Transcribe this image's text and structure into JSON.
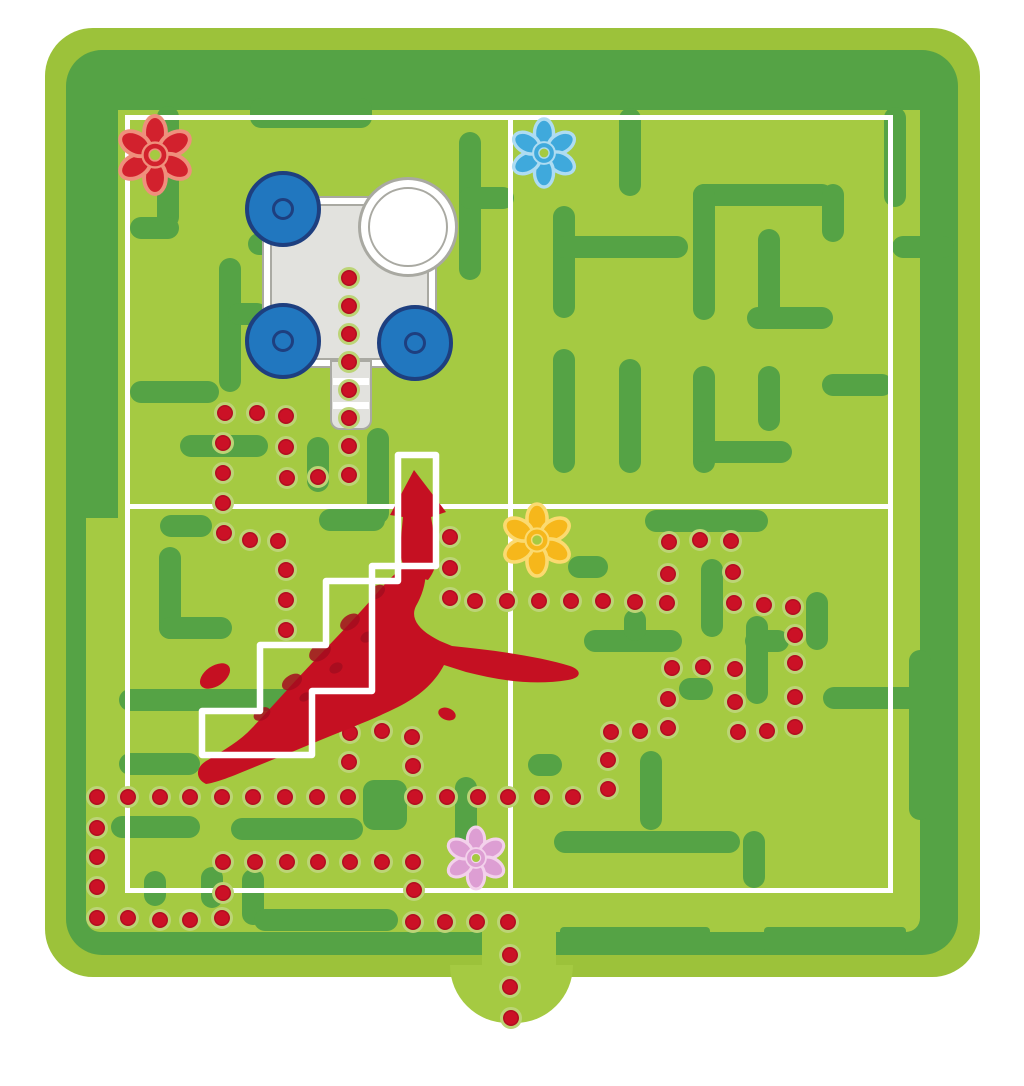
{
  "title": "garden-maze-game-board",
  "colors": {
    "page": "#ffffff",
    "rim_green": "#9cc23a",
    "band_green": "#55a345",
    "play_green": "#a5ca42",
    "wall_green": "#55a345",
    "dot_red": "#cb1126",
    "dot_outline": "#bcd476",
    "line_white": "#ffffff",
    "cart_gray": "#e2e2de",
    "cart_line_gray": "#a9a9a2",
    "wheel_blue": "#2177bf",
    "wheel_rim_blue": "#1e3f7f",
    "dragon_red": "#c51022",
    "dragon_dark_red": "#a30d1e"
  },
  "board": {
    "base": {
      "x": 45,
      "y": 28,
      "w": 935,
      "h": 949
    },
    "band": {
      "x": 66,
      "y": 50,
      "w": 892,
      "h": 905
    },
    "play": {
      "x": 86,
      "y": 90,
      "w": 834,
      "h": 842
    },
    "exit_gap": {
      "x": 482,
      "y": 918,
      "w": 74,
      "h": 52
    },
    "exit_bump": {
      "x": 450,
      "y": 965,
      "w": 123,
      "h": 58
    }
  },
  "white_lines": {
    "inset_rect": {
      "x": 125,
      "y": 115,
      "w": 768,
      "h": 778,
      "stroke": 5
    },
    "v_center": {
      "x": 508,
      "y": 120,
      "w": 5,
      "h": 773
    },
    "h_center": {
      "x": 125,
      "y": 504,
      "w": 768,
      "h": 5
    }
  },
  "walls": [
    [
      86,
      90,
      834,
      20,
      0
    ],
    [
      86,
      90,
      32,
      428,
      0
    ],
    [
      157,
      106,
      22,
      122
    ],
    [
      130,
      217,
      49,
      22
    ],
    [
      248,
      233,
      44,
      22
    ],
    [
      250,
      98,
      122,
      30
    ],
    [
      219,
      258,
      22,
      134
    ],
    [
      130,
      381,
      89,
      22
    ],
    [
      228,
      303,
      40,
      22
    ],
    [
      459,
      132,
      22,
      148
    ],
    [
      459,
      187,
      55,
      22
    ],
    [
      180,
      435,
      88,
      22
    ],
    [
      307,
      437,
      22,
      55
    ],
    [
      367,
      428,
      22,
      96
    ],
    [
      160,
      515,
      52,
      22
    ],
    [
      319,
      509,
      66,
      22
    ],
    [
      619,
      108,
      22,
      88
    ],
    [
      553,
      206,
      22,
      112
    ],
    [
      553,
      236,
      135,
      22
    ],
    [
      693,
      184,
      140,
      22
    ],
    [
      693,
      184,
      22,
      136
    ],
    [
      747,
      307,
      86,
      22
    ],
    [
      758,
      229,
      22,
      100
    ],
    [
      822,
      184,
      22,
      58
    ],
    [
      884,
      107,
      22,
      100
    ],
    [
      892,
      236,
      62,
      22
    ],
    [
      553,
      349,
      22,
      124
    ],
    [
      619,
      359,
      22,
      114
    ],
    [
      693,
      366,
      22,
      107
    ],
    [
      693,
      441,
      99,
      22
    ],
    [
      758,
      366,
      22,
      65
    ],
    [
      822,
      374,
      71,
      22
    ],
    [
      645,
      510,
      123,
      22
    ],
    [
      701,
      559,
      22,
      78
    ],
    [
      584,
      630,
      98,
      22
    ],
    [
      624,
      609,
      22,
      32
    ],
    [
      745,
      630,
      44,
      22
    ],
    [
      806,
      592,
      22,
      58
    ],
    [
      679,
      678,
      34,
      22
    ],
    [
      823,
      687,
      107,
      22
    ],
    [
      746,
      616,
      22,
      88
    ],
    [
      909,
      650,
      22,
      170
    ],
    [
      640,
      751,
      22,
      79
    ],
    [
      554,
      831,
      186,
      22
    ],
    [
      743,
      831,
      22,
      57
    ],
    [
      528,
      754,
      34,
      22
    ],
    [
      568,
      556,
      40,
      22
    ],
    [
      159,
      547,
      22,
      92
    ],
    [
      159,
      617,
      73,
      22
    ],
    [
      119,
      689,
      202,
      22
    ],
    [
      119,
      753,
      81,
      22
    ],
    [
      111,
      816,
      89,
      22
    ],
    [
      231,
      818,
      132,
      22
    ],
    [
      363,
      780,
      44,
      50
    ],
    [
      455,
      777,
      22,
      92
    ],
    [
      201,
      867,
      22,
      41
    ],
    [
      242,
      869,
      22,
      56
    ],
    [
      254,
      909,
      144,
      22
    ],
    [
      144,
      871,
      22,
      35
    ],
    [
      560,
      927,
      150,
      26,
      4
    ],
    [
      764,
      927,
      142,
      26,
      4
    ]
  ],
  "dots": [
    [
      349,
      278
    ],
    [
      349,
      306
    ],
    [
      349,
      334
    ],
    [
      349,
      362
    ],
    [
      349,
      390
    ],
    [
      349,
      418
    ],
    [
      349,
      446
    ],
    [
      349,
      475
    ],
    [
      318,
      477
    ],
    [
      287,
      478
    ],
    [
      286,
      447
    ],
    [
      286,
      416
    ],
    [
      257,
      413
    ],
    [
      225,
      413
    ],
    [
      223,
      443
    ],
    [
      223,
      473
    ],
    [
      223,
      503
    ],
    [
      224,
      533
    ],
    [
      250,
      540
    ],
    [
      278,
      541
    ],
    [
      286,
      570
    ],
    [
      286,
      600
    ],
    [
      286,
      630
    ],
    [
      450,
      537
    ],
    [
      450,
      568
    ],
    [
      450,
      598
    ],
    [
      475,
      601
    ],
    [
      507,
      601
    ],
    [
      539,
      601
    ],
    [
      571,
      601
    ],
    [
      603,
      601
    ],
    [
      635,
      602
    ],
    [
      667,
      603
    ],
    [
      668,
      574
    ],
    [
      669,
      542
    ],
    [
      700,
      540
    ],
    [
      731,
      541
    ],
    [
      733,
      572
    ],
    [
      734,
      603
    ],
    [
      764,
      605
    ],
    [
      793,
      607
    ],
    [
      795,
      635
    ],
    [
      795,
      663
    ],
    [
      795,
      697
    ],
    [
      795,
      727
    ],
    [
      767,
      731
    ],
    [
      738,
      732
    ],
    [
      735,
      702
    ],
    [
      735,
      669
    ],
    [
      703,
      667
    ],
    [
      672,
      668
    ],
    [
      668,
      699
    ],
    [
      668,
      728
    ],
    [
      640,
      731
    ],
    [
      611,
      732
    ],
    [
      608,
      760
    ],
    [
      608,
      789
    ],
    [
      573,
      797
    ],
    [
      542,
      797
    ],
    [
      508,
      797
    ],
    [
      478,
      797
    ],
    [
      447,
      797
    ],
    [
      415,
      797
    ],
    [
      413,
      766
    ],
    [
      412,
      737
    ],
    [
      382,
      731
    ],
    [
      350,
      733
    ],
    [
      349,
      762
    ],
    [
      348,
      797
    ],
    [
      317,
      797
    ],
    [
      285,
      797
    ],
    [
      253,
      797
    ],
    [
      222,
      797
    ],
    [
      190,
      797
    ],
    [
      160,
      797
    ],
    [
      128,
      797
    ],
    [
      97,
      797
    ],
    [
      97,
      828
    ],
    [
      97,
      857
    ],
    [
      97,
      887
    ],
    [
      97,
      918
    ],
    [
      128,
      918
    ],
    [
      160,
      920
    ],
    [
      190,
      920
    ],
    [
      222,
      918
    ],
    [
      223,
      893
    ],
    [
      223,
      862
    ],
    [
      255,
      862
    ],
    [
      287,
      862
    ],
    [
      318,
      862
    ],
    [
      350,
      862
    ],
    [
      382,
      862
    ],
    [
      413,
      862
    ],
    [
      414,
      890
    ],
    [
      413,
      922
    ],
    [
      445,
      922
    ],
    [
      477,
      922
    ],
    [
      508,
      922
    ],
    [
      510,
      955
    ],
    [
      510,
      987
    ],
    [
      511,
      1018
    ]
  ],
  "flowers": [
    {
      "id": "flower-red",
      "x": 155,
      "y": 155,
      "size": 78,
      "color": "#d2212d",
      "outline": "#ef8f7c"
    },
    {
      "id": "flower-blue",
      "x": 544,
      "y": 153,
      "size": 68,
      "color": "#3fa9dc",
      "outline": "#aedcf2"
    },
    {
      "id": "flower-yellow",
      "x": 537,
      "y": 540,
      "size": 72,
      "color": "#f6b71b",
      "outline": "#fbda70"
    },
    {
      "id": "flower-pink",
      "x": 476,
      "y": 858,
      "size": 62,
      "color": "#dd9ed3",
      "outline": "#f3d1eb"
    }
  ],
  "cart": {
    "body": {
      "x": 262,
      "y": 196,
      "w": 175,
      "h": 172
    },
    "inner_inset": 8,
    "handle": {
      "x": 330,
      "y": 360,
      "w": 42,
      "h": 70
    },
    "handle_stripes": [
      378,
      402
    ],
    "wheels": [
      [
        283,
        209
      ],
      [
        283,
        341
      ],
      [
        415,
        343
      ]
    ],
    "wheel_r": 38,
    "ring": {
      "cx": 408,
      "cy": 227,
      "r": 50,
      "inner_r": 40
    }
  },
  "dragon": {
    "body_path": "M206,784 C194,778 196,766 208,760 C224,750 240,741 252,728 C272,707 292,684 314,661 C336,638 358,615 378,592 C390,578 398,570 408,566 L424,562 C428,576 424,592 416,606 C410,618 418,630 440,641 L452,646 C492,650 538,656 570,666 C582,670 582,678 568,680 C532,686 498,680 466,672 L444,665 C434,684 418,697 398,707 C374,719 350,728 328,737 C304,747 282,756 262,764 C242,772 220,782 206,784 Z",
    "arrow_path": "M414,470 L390,515 L403,517 L400,548 C400,560 404,570 412,576 L428,580 C436,570 438,558 436,546 L431,517 L446,512 Z",
    "left_flipper": {
      "cx": 215,
      "cy": 676,
      "rx": 17,
      "ry": 10,
      "rot": -35
    },
    "right_nub": {
      "cx": 447,
      "cy": 714,
      "rx": 9,
      "ry": 6,
      "rot": 20
    },
    "spots": [
      [
        262,
        714,
        9,
        6,
        -30
      ],
      [
        292,
        682,
        11,
        7,
        -32
      ],
      [
        320,
        652,
        12,
        8,
        -35
      ],
      [
        350,
        622,
        11,
        7,
        -35
      ],
      [
        377,
        592,
        9,
        6,
        -38
      ],
      [
        336,
        668,
        7,
        5,
        -30
      ],
      [
        305,
        697,
        6,
        4,
        -30
      ],
      [
        367,
        637,
        7,
        5,
        -33
      ]
    ]
  },
  "staircase": {
    "path": "M398,455 L436,455 L436,566 L372,566 L372,691 L312,691 L312,755 L202,755 L202,711 L260,711 L260,645 L326,645 L326,581 L398,581 Z",
    "stroke_width": 6.5
  }
}
